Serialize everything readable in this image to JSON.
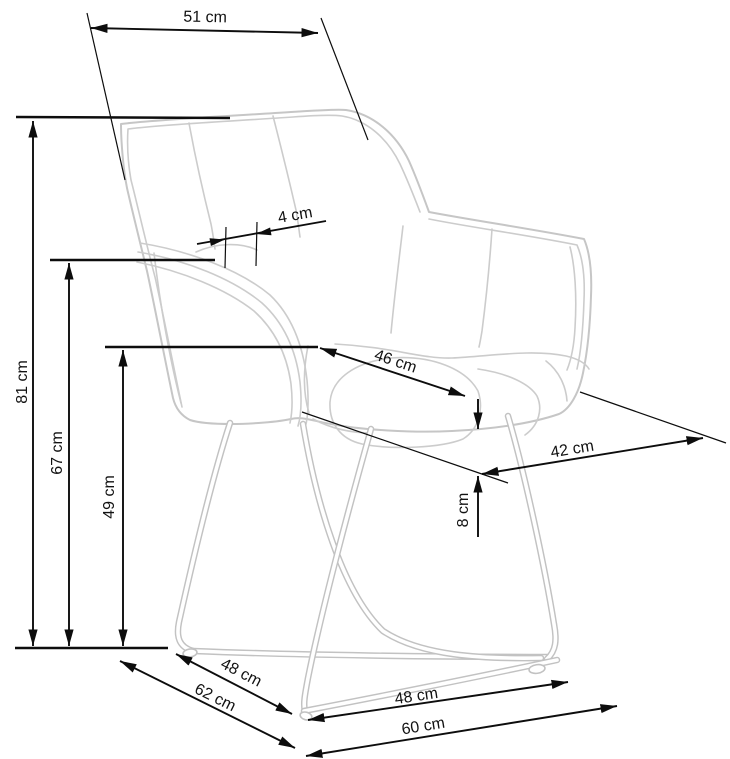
{
  "diagram": {
    "title": "armchair-dimension-drawing",
    "unit": "cm",
    "colors": {
      "background": "#ffffff",
      "chair_outline": "#c6c6c6",
      "dimension_lines": "#0d0d0d",
      "label_text": "#121212"
    },
    "dimensions": {
      "d51": "51 cm",
      "d4": "4 cm",
      "d46": "46 cm",
      "d42": "42 cm",
      "d8": "8 cm",
      "d81": "81 cm",
      "d67": "67 cm",
      "d49": "49 cm",
      "d48_side": "48 cm",
      "d62": "62 cm",
      "d48_front": "48 cm",
      "d60": "60 cm"
    }
  }
}
